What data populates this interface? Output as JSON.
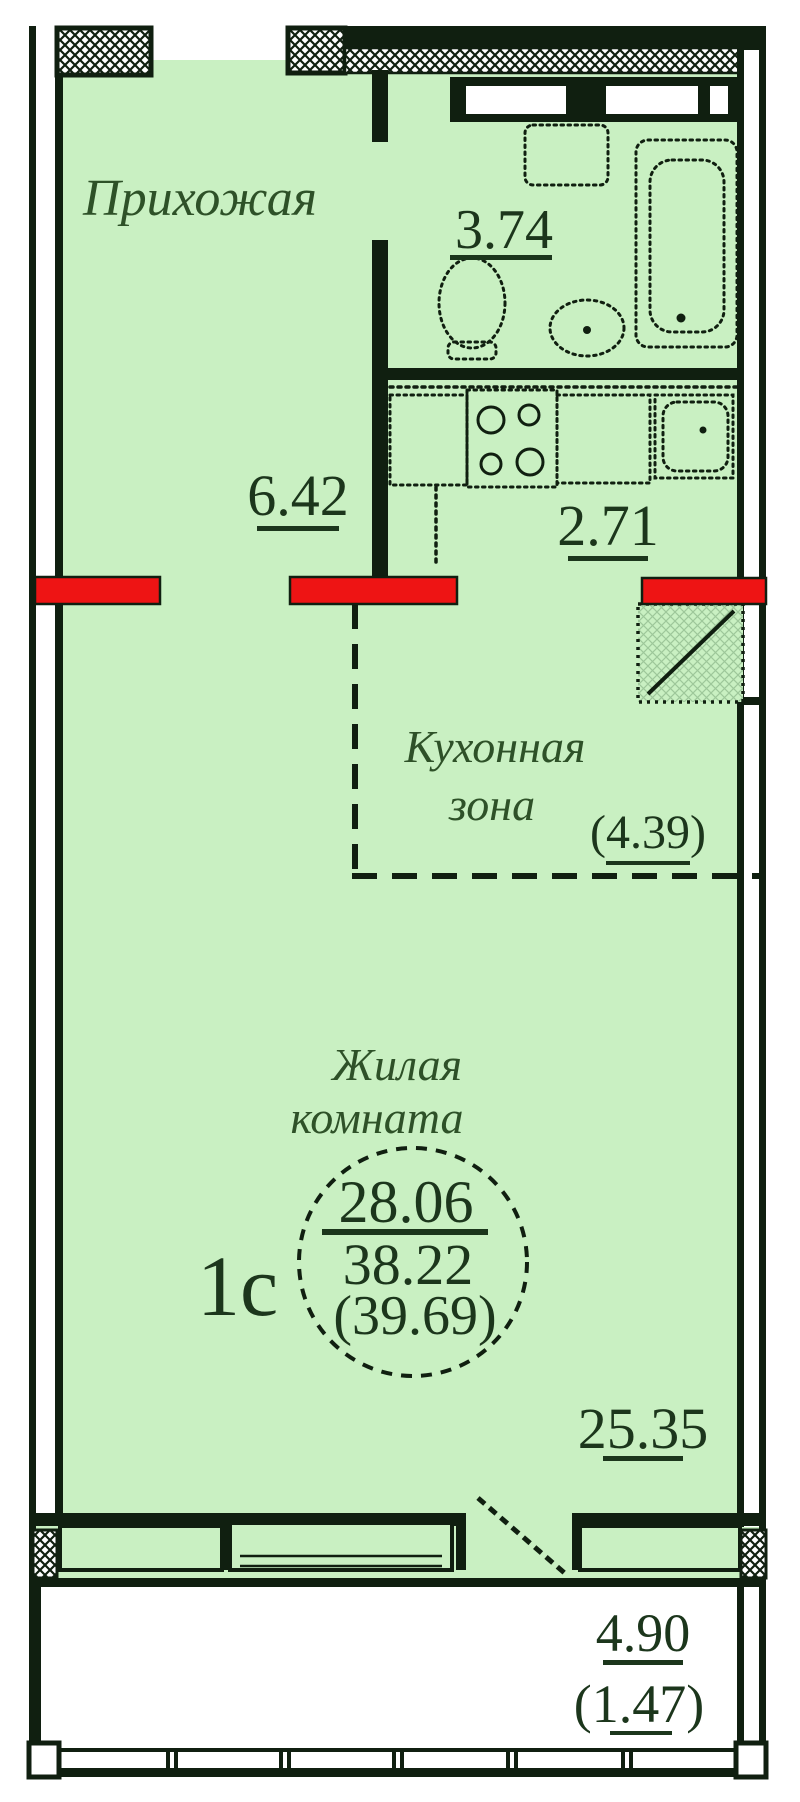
{
  "page": {
    "title": "План квартиры-студии 1с"
  },
  "colors": {
    "wall": "#101f10",
    "floor": "#c9f0c2",
    "label": "#2e5128",
    "number": "#1c361c",
    "accent_red": "#ee1414",
    "balcony": "#ffffff"
  },
  "rooms": {
    "hallway": {
      "name": "Прихожая",
      "area": "6.42"
    },
    "bathroom": {
      "area": "3.74"
    },
    "kitchen": {
      "area": "2.71"
    },
    "kitchen_zone": {
      "line1": "Кухонная",
      "line2": "зона",
      "area": "(4.39)"
    },
    "living": {
      "line1": "Жилая",
      "line2": "комната",
      "area": "25.35"
    },
    "balcony": {
      "area": "4.90",
      "area_coeff": "(1.47)"
    }
  },
  "stamp": {
    "type": "1с",
    "living_area": "28.06",
    "area_main": "38.22",
    "area_total": "(39.69)"
  },
  "fixtures": {
    "bathtub": "bathtub-icon",
    "toilet": "toilet-icon",
    "sink": "sink-icon",
    "washing_machine": "washer-icon",
    "stove": "stove-icon",
    "kitchen_sink": "kitchen-sink-icon",
    "vent_shaft": "vent-shaft-icon",
    "balcony_door": "door-swing-icon",
    "window": "window-icon",
    "railing": "railing-icon"
  }
}
